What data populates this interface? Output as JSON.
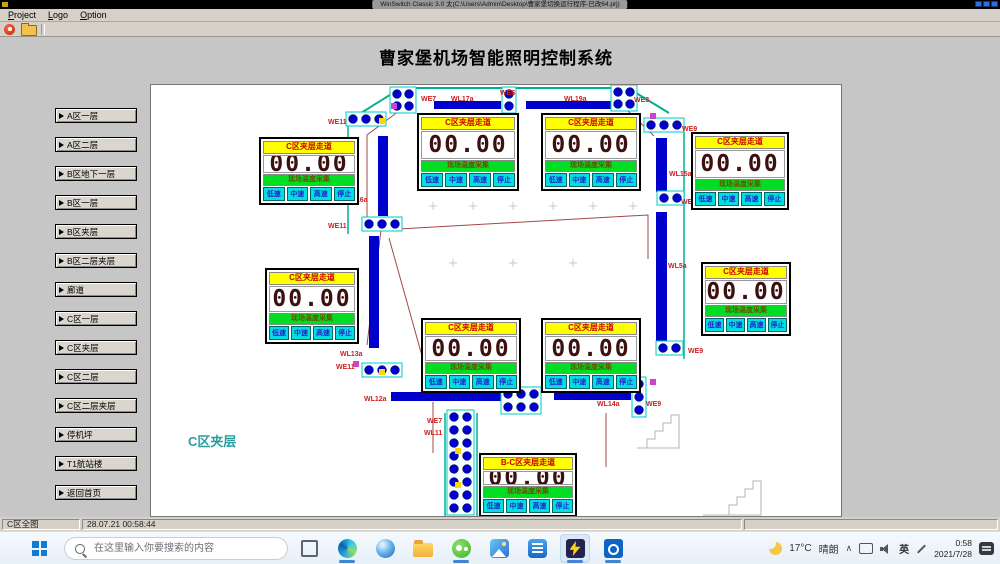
{
  "window": {
    "title": "WinSwitch Classic 3.0 太(C:\\Users\\Admin\\Desktop\\曹家堡切换运行程序-已改64.prj)",
    "menus": [
      "Project",
      "Logo",
      "Option"
    ],
    "control_icons": [
      "minimize-icon",
      "maximize-icon",
      "close-icon"
    ],
    "toolbar_icons": [
      "stop-icon",
      "open-project-icon"
    ]
  },
  "app": {
    "heading": "曹家堡机场智能照明控制系统",
    "sidebar": [
      "A区一层",
      "A区二层",
      "B区地下一层",
      "B区一层",
      "B区夹层",
      "B区二层夹层",
      "廊道",
      "C区一层",
      "C区夹层",
      "C区二层",
      "C区二层夹层",
      "停机坪",
      "T1航站楼",
      "返回首页"
    ]
  },
  "colors": {
    "busbar": "#0000cc",
    "label": "#cc2020",
    "maroon": "#a04848",
    "teal": "#00b090",
    "gray": "#b4b4b4",
    "yellow": "#ffd400",
    "magenta": "#cc44cc",
    "panel_yellow": "#ffff00",
    "panel_green": "#00dd22",
    "button_cyan": "#00e0e0"
  },
  "plan": {
    "area_label": "C区夹层",
    "panel_title_default": "C区夹层走道",
    "sensor_label": "现场温度采集",
    "value": "00.00",
    "speed_buttons": [
      "低速",
      "中速",
      "高速",
      "停止"
    ],
    "panels": [
      {
        "x": 258,
        "y": 136,
        "w": 100,
        "h": 68
      },
      {
        "x": 416,
        "y": 112,
        "w": 102,
        "h": 78
      },
      {
        "x": 540,
        "y": 112,
        "w": 100,
        "h": 78
      },
      {
        "x": 690,
        "y": 131,
        "w": 98,
        "h": 78
      },
      {
        "x": 264,
        "y": 267,
        "w": 94,
        "h": 76
      },
      {
        "x": 700,
        "y": 261,
        "w": 90,
        "h": 74
      },
      {
        "x": 420,
        "y": 317,
        "w": 100,
        "h": 75
      },
      {
        "x": 540,
        "y": 317,
        "w": 100,
        "h": 75
      },
      {
        "x": 478,
        "y": 452,
        "w": 98,
        "h": 64,
        "title": "B-C区夹层走道"
      }
    ],
    "bars": [
      [
        433,
        100,
        67,
        8
      ],
      [
        525,
        100,
        92,
        8
      ],
      [
        377,
        135,
        10,
        80
      ],
      [
        368,
        235,
        10,
        112
      ],
      [
        655,
        137,
        11,
        54
      ],
      [
        655,
        211,
        11,
        130
      ],
      [
        390,
        391,
        113,
        9
      ],
      [
        553,
        390,
        77,
        9
      ]
    ],
    "labels": [
      [
        "WE7",
        420,
        97
      ],
      [
        "WL17a",
        450,
        97
      ],
      [
        "WE6",
        499,
        91
      ],
      [
        "WL19a",
        563,
        97
      ],
      [
        "WE3",
        633,
        98
      ],
      [
        "WE11",
        327,
        120
      ],
      [
        "WE9",
        681,
        127
      ],
      [
        "WL16a",
        344,
        198
      ],
      [
        "WL15a",
        668,
        172
      ],
      [
        "WE11",
        327,
        224
      ],
      [
        "WE9",
        680,
        200
      ],
      [
        "WL5a",
        667,
        264
      ],
      [
        "WE9",
        687,
        349
      ],
      [
        "WL13a",
        339,
        352
      ],
      [
        "WE11",
        335,
        365
      ],
      [
        "WL12a",
        363,
        397
      ],
      [
        "WL14a",
        596,
        402
      ],
      [
        "WE7",
        426,
        419
      ],
      [
        "WL11",
        423,
        431
      ],
      [
        "WE9",
        645,
        402
      ]
    ],
    "clusters": [
      [
        [
          396,
          93
        ],
        [
          408,
          93
        ],
        [
          396,
          105
        ],
        [
          408,
          105
        ]
      ],
      [
        [
          508,
          93
        ],
        [
          508,
          105
        ]
      ],
      [
        [
          617,
          91
        ],
        [
          629,
          91
        ],
        [
          617,
          103
        ],
        [
          629,
          103
        ]
      ],
      [
        [
          352,
          118
        ],
        [
          365,
          118
        ],
        [
          378,
          118
        ]
      ],
      [
        [
          650,
          124
        ],
        [
          663,
          124
        ],
        [
          676,
          124
        ]
      ],
      [
        [
          368,
          223
        ],
        [
          381,
          223
        ],
        [
          394,
          223
        ]
      ],
      [
        [
          663,
          197
        ],
        [
          676,
          197
        ]
      ],
      [
        [
          662,
          347
        ],
        [
          675,
          347
        ]
      ],
      [
        [
          368,
          369
        ],
        [
          381,
          369
        ],
        [
          394,
          369
        ]
      ],
      [
        [
          507,
          393
        ],
        [
          520,
          393
        ],
        [
          533,
          393
        ],
        [
          507,
          406
        ],
        [
          520,
          406
        ],
        [
          533,
          406
        ]
      ],
      [
        [
          638,
          383
        ],
        [
          638,
          396
        ],
        [
          638,
          409
        ]
      ],
      [
        [
          453,
          416
        ],
        [
          466,
          416
        ],
        [
          453,
          429
        ],
        [
          466,
          429
        ],
        [
          453,
          442
        ],
        [
          466,
          442
        ],
        [
          453,
          455
        ],
        [
          466,
          455
        ],
        [
          453,
          468
        ],
        [
          466,
          468
        ],
        [
          453,
          481
        ],
        [
          466,
          481
        ],
        [
          453,
          494
        ],
        [
          466,
          494
        ],
        [
          453,
          507
        ],
        [
          466,
          507
        ]
      ]
    ],
    "lines": [
      {
        "c": "teal",
        "w": 2,
        "pts": "400,87 627,87"
      },
      {
        "c": "teal",
        "w": 2,
        "pts": "400,87 360,112"
      },
      {
        "c": "teal",
        "w": 2,
        "pts": "627,87 668,112"
      },
      {
        "c": "teal",
        "w": 1.5,
        "pts": "347,112 347,233"
      },
      {
        "c": "teal",
        "w": 1.5,
        "pts": "683,131 683,358"
      },
      {
        "c": "teal",
        "w": 1.5,
        "pts": "444,412 444,516"
      },
      {
        "c": "teal",
        "w": 1.5,
        "pts": "476,412 476,516"
      },
      {
        "c": "maroon",
        "w": 1,
        "pts": "398,110 366,134 366,220"
      },
      {
        "c": "maroon",
        "w": 1,
        "pts": "627,110 653,135"
      },
      {
        "c": "maroon",
        "w": 1,
        "pts": "380,229 647,214 647,258"
      },
      {
        "c": "maroon",
        "w": 1,
        "pts": "380,229 366,344"
      },
      {
        "c": "maroon",
        "w": 1,
        "pts": "388,237 430,387"
      },
      {
        "c": "maroon",
        "w": 1,
        "pts": "432,401 432,452"
      },
      {
        "c": "maroon",
        "w": 1,
        "pts": "605,412 605,466"
      },
      {
        "c": "gray",
        "w": 1,
        "pts": "636,447 678,447 678,414 670,414 670,422 662,422 662,430 654,430 654,438 646,438 646,447"
      },
      {
        "c": "gray",
        "w": 1,
        "pts": "702,514 760,514 760,480 752,480 752,488 744,488 744,496 736,496 736,504 728,504 728,514"
      }
    ],
    "marks": [
      [
        "yellow",
        381,
        120
      ],
      [
        "yellow",
        381,
        371
      ],
      [
        "yellow",
        457,
        450
      ],
      [
        "yellow",
        457,
        484
      ],
      [
        "yellow",
        627,
        343
      ],
      [
        "magenta",
        393,
        105
      ],
      [
        "magenta",
        652,
        115
      ],
      [
        "magenta",
        355,
        363
      ],
      [
        "magenta",
        652,
        381
      ]
    ],
    "crosses": [
      [
        432,
        205
      ],
      [
        472,
        205
      ],
      [
        512,
        205
      ],
      [
        552,
        205
      ],
      [
        592,
        205
      ],
      [
        632,
        205
      ],
      [
        452,
        262
      ],
      [
        512,
        262
      ],
      [
        572,
        262
      ]
    ]
  },
  "statusbar": {
    "left": "C区全图",
    "timestamp": "28.07.21 00:58:44"
  },
  "taskbar": {
    "search_placeholder": "在这里输入你要搜索的内容",
    "icons": [
      "task-view",
      "edge",
      "browser",
      "folder",
      "wechat",
      "photos",
      "tim",
      "winswitch",
      "outlook"
    ],
    "open_apps": [
      "edge",
      "wechat",
      "winswitch",
      "outlook"
    ],
    "active_app": "winswitch",
    "tray": {
      "weather_icon": "moon-icon",
      "temp": "17°C",
      "cond": "晴朗",
      "lang": "英",
      "time": "0:58",
      "date": "2021/7/28"
    }
  }
}
